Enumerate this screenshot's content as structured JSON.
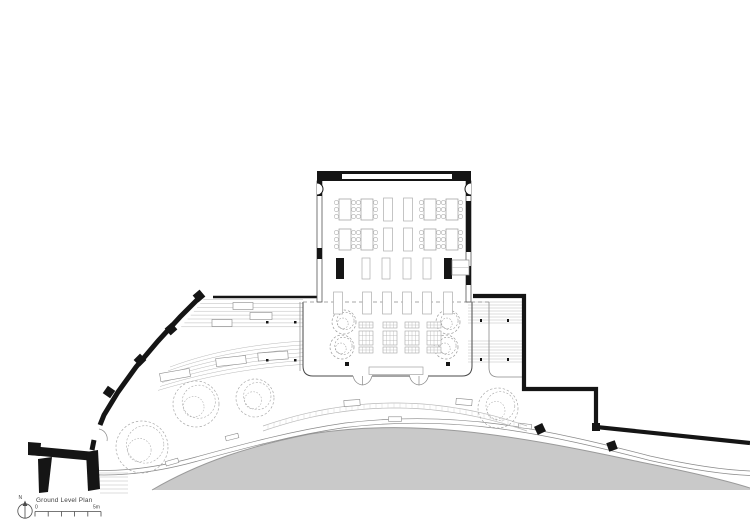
{
  "drawing": {
    "title": "Ground Level Plan",
    "north_label": "N",
    "scale": {
      "start_label": "0",
      "end_label": "5m"
    }
  },
  "colors": {
    "wall": "#151515",
    "paving": "#c9c9c9",
    "paving_edge": "#9a9a9a",
    "line_dark": "#4a4a4a",
    "line_mid": "#8a8a8a",
    "line_light": "#b9b9b9",
    "furniture": "#a3a3a3",
    "tree": "#a9a9a9",
    "tree_dark": "#979797"
  }
}
